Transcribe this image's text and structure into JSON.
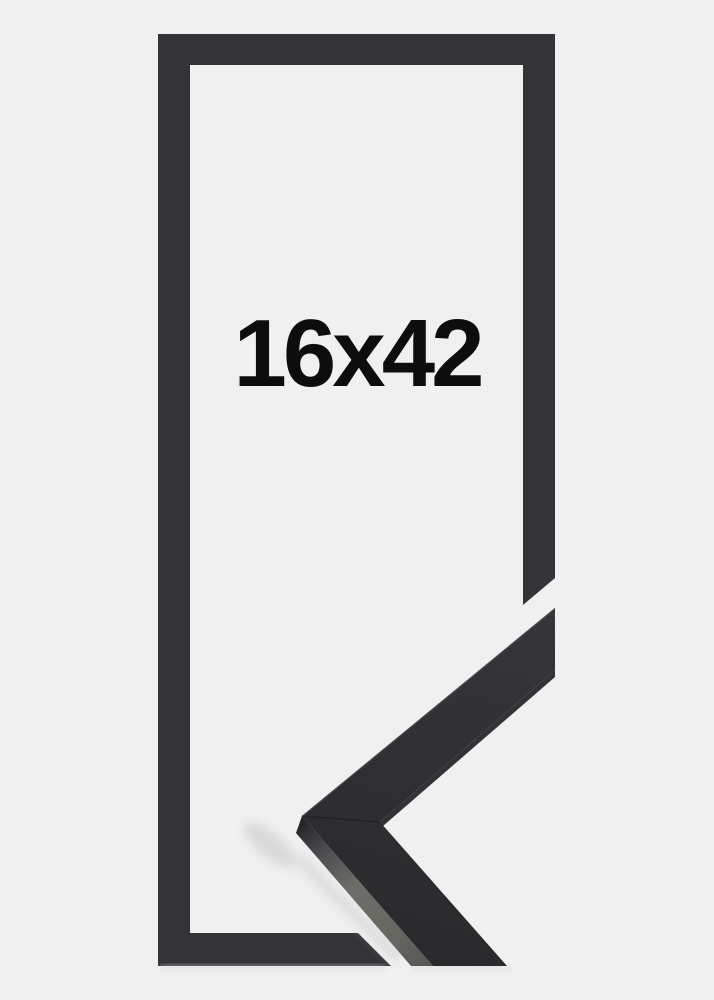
{
  "product": {
    "size_label": "16x42"
  },
  "colors": {
    "background": "#f0f0f1",
    "frame_outline": "#343438",
    "moulding_face_light": "#36363a",
    "moulding_face_dark": "#2a2a2d",
    "moulding_side": "#6e6e69",
    "moulding_inner_edge": "#1e1e22",
    "label_text": "#0d0d0e",
    "shadow": "#c9c9c9"
  }
}
